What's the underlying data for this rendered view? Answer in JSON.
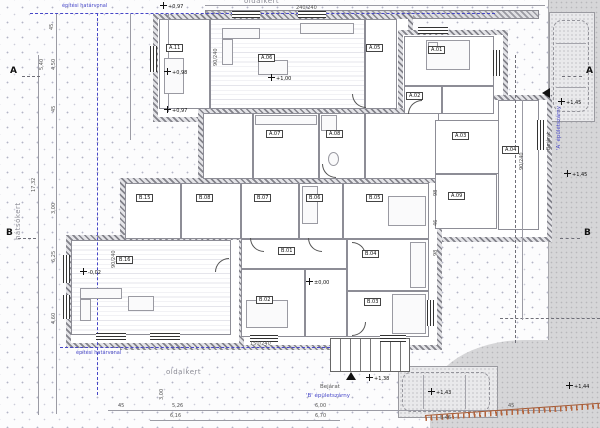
{
  "site": {
    "garden_top": "oldalkert",
    "garden_bottom": "oldalkert",
    "garden_left": "hátsókert",
    "boundary_top": "építési határvonal",
    "boundary_bottom": "építési határvonal",
    "wing_a": "'A' épületszárny",
    "wing_b": "'B' épületszárny",
    "entrance_a": "Bejárat",
    "entrance_b": "Bejárat",
    "section_a": "A",
    "section_b": "B"
  },
  "elevations": {
    "e097a": "+0,97",
    "e098": "+0,98",
    "e100": "+1,00",
    "e097b": "+0,97",
    "e145a": "+1,45",
    "e145b": "+1,45",
    "e000": "±0,00",
    "e002": "-0,02",
    "e138": "+1,38",
    "e143": "+1,43",
    "e144": "+1,44"
  },
  "rooms": [
    {
      "label": "A.11"
    },
    {
      "label": "A.06"
    },
    {
      "label": "A.05"
    },
    {
      "label": "A.01"
    },
    {
      "label": "A.02"
    },
    {
      "label": "A.07"
    },
    {
      "label": "A.08"
    },
    {
      "label": "A.03"
    },
    {
      "label": "A.04"
    },
    {
      "label": "A.09"
    },
    {
      "label": "B.15"
    },
    {
      "label": "B.08"
    },
    {
      "label": "B.07"
    },
    {
      "label": "B.06"
    },
    {
      "label": "B.05"
    },
    {
      "label": "B.01"
    },
    {
      "label": "B.04"
    },
    {
      "label": "B.16"
    },
    {
      "label": "B.02"
    },
    {
      "label": "B.03"
    }
  ],
  "dimensions": {
    "left": [
      "45",
      "5,40",
      "4,50",
      "45",
      "17,32",
      "3,00",
      "6,25",
      "4,60"
    ],
    "bottom": [
      "45",
      "5,26",
      "6,16",
      "3,00",
      "6,00",
      "6,70",
      "5,46",
      "45"
    ],
    "right": [
      "98",
      "46",
      "98"
    ],
    "window_tags": [
      "90/240",
      "90/240",
      "150/240",
      "90/240",
      "240/240"
    ]
  },
  "colors": {
    "boundary_blue": "#4646c8",
    "paving_gray": "#d6d6d8",
    "wall_hatch": "#83838b",
    "marker_red": "#b4643c"
  }
}
